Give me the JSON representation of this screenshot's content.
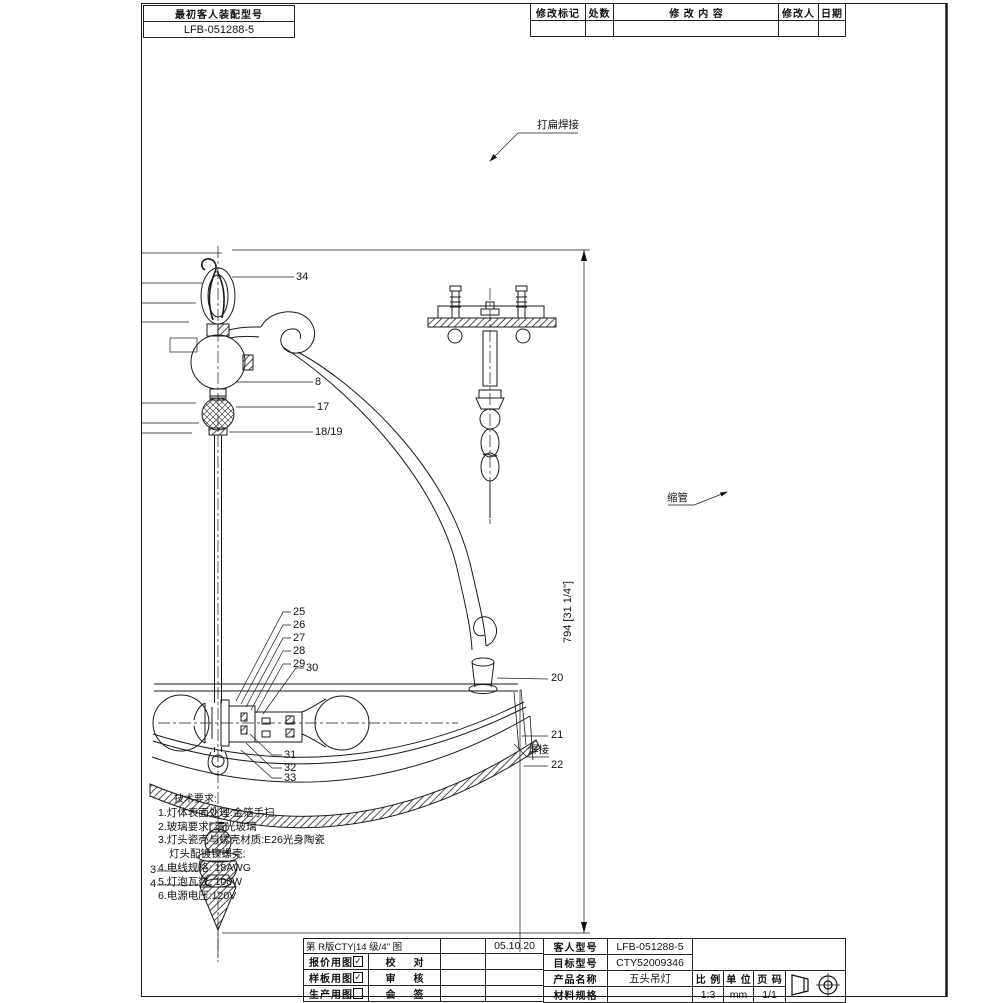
{
  "header": {
    "model_box": {
      "title": "最初客人装配型号",
      "model": "LFB-051288-5"
    },
    "revision": {
      "mark": "修改标记",
      "qty": "处数",
      "content": "修改内容",
      "person": "修改人",
      "date": "日期"
    }
  },
  "callouts": {
    "flatten_weld": "打扁焊接",
    "shrink_tube": "缩管",
    "weld": "焊接",
    "dim_overall": "794 [31 1/4\"]",
    "p34": "34",
    "p8": "8",
    "p17": "17",
    "p18_19": "18/19",
    "p25": "25",
    "p26": "26",
    "p27": "27",
    "p28": "28",
    "p29": "29",
    "p30": "30",
    "p31": "31",
    "p32": "32",
    "p33": "33",
    "p20": "20",
    "p21": "21",
    "p22": "22",
    "p3": "3",
    "p4": "4"
  },
  "tech_notes": {
    "title": "技术要求:",
    "l1": "1.灯体表面处理:金箔手扫",
    "l2": "2.玻璃要求: 清光玻璃",
    "l3": "3.灯头瓷壳与螺壳材质:E26光身陶瓷",
    "l4": "灯头配镀镍螺壳;",
    "l5": "4.电线规格: 18AWG",
    "l6": "5.灯泡瓦数: 100W",
    "l7": "6.电源电压:120V"
  },
  "title_block": {
    "left": {
      "row1_text": "第 R版CTY|14 级/4\" 图",
      "row1_date": "05.10.20",
      "quote_drawing": "报价用图",
      "sample_drawing": "样板用图",
      "production_drawing": "生产用图",
      "check": "校对",
      "review": "审核",
      "countersign": "会签",
      "quote_checked": "✓",
      "sample_checked": "✓",
      "production_checked": ""
    },
    "right": {
      "customer_model_label": "客人型号",
      "customer_model": "LFB-051288-5",
      "target_model_label": "目标型号",
      "target_model": "CTY52009346",
      "product_name_label": "产品名称",
      "product_name": "五头吊灯",
      "material_label": "材料规格",
      "material": "",
      "scale_label": "比例",
      "scale": "1:3",
      "unit_label": "单位",
      "unit": "mm",
      "page_label": "页码",
      "page": "1/1"
    }
  }
}
